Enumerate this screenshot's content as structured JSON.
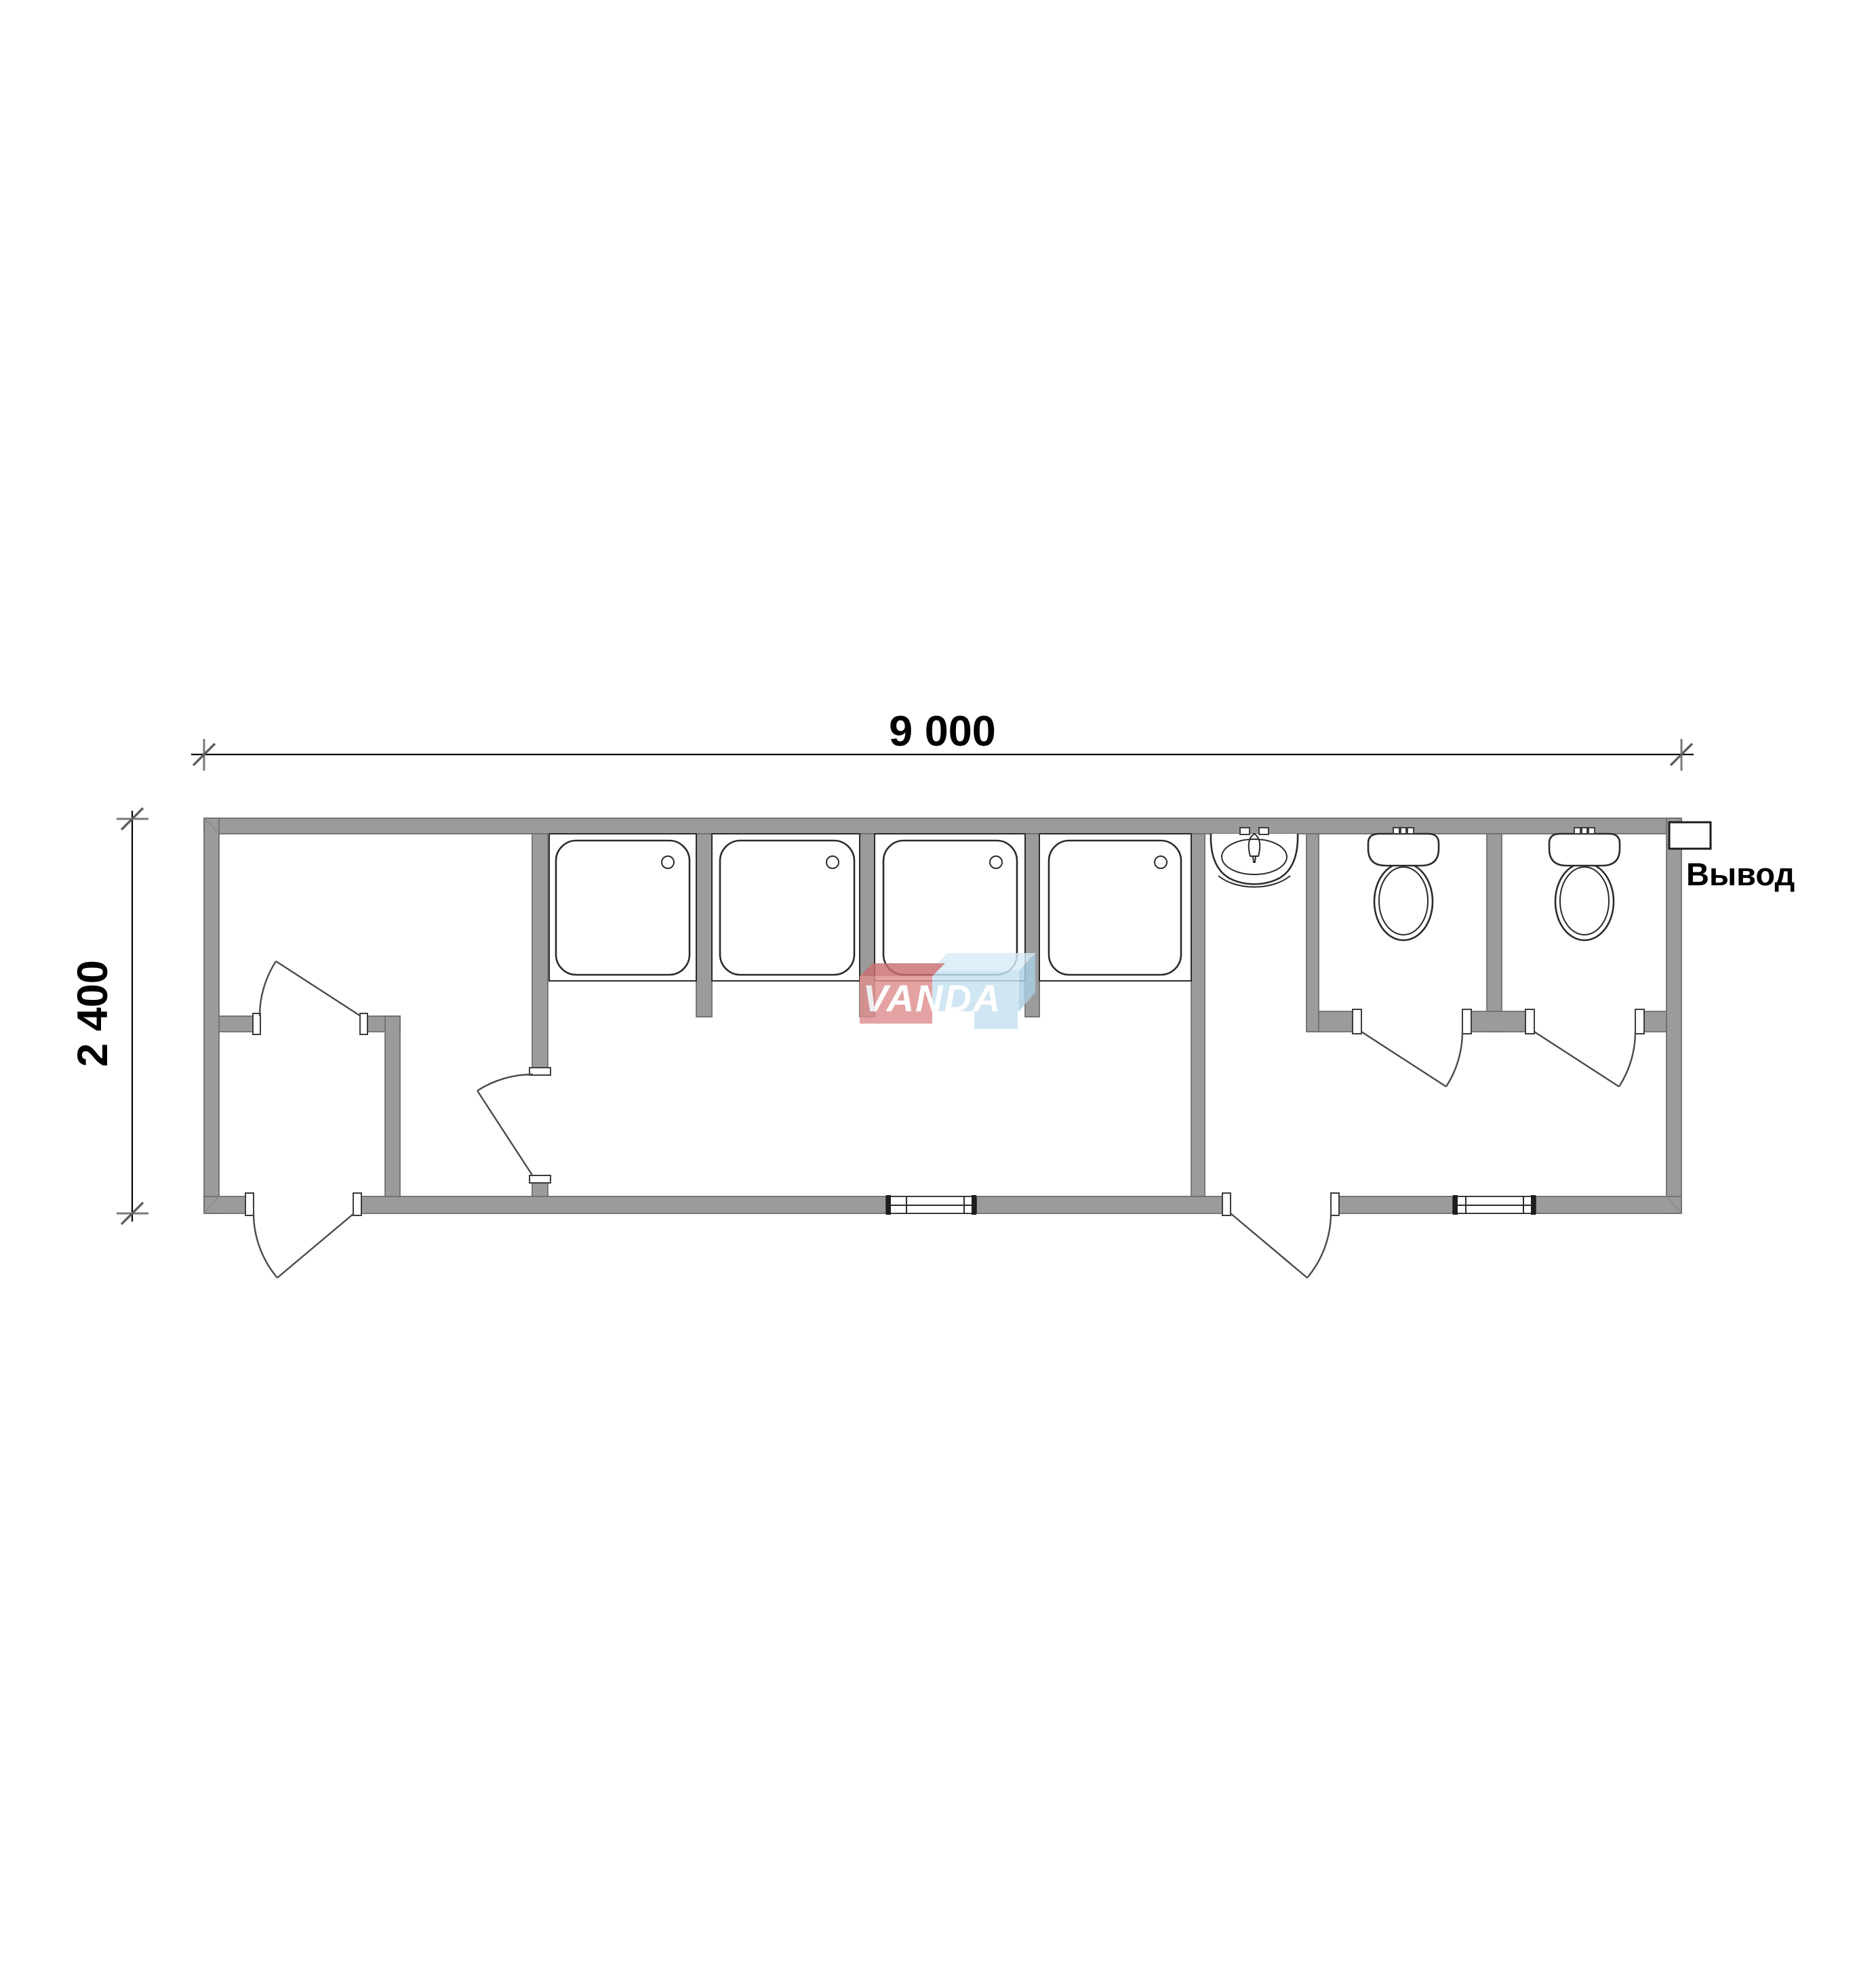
{
  "dimensions": {
    "width_label": "9 000",
    "height_label": "2 400"
  },
  "callouts": {
    "outlet_label": "Вывод"
  },
  "watermark": {
    "text": "VANDA"
  },
  "colors": {
    "background": "#ffffff",
    "wall_fill": "#9b9b9b",
    "wall_edge": "#6f6f6f",
    "line": "#2b2b2b",
    "door": "#4a4a4a",
    "dim": "#000000",
    "tick": "#7a7a7a",
    "logo_red": "#e08e8e",
    "logo_red_dark": "#ca6f72",
    "logo_blue": "#c6e1f0",
    "logo_blue_light": "#d9ecf6",
    "logo_blue_dark": "#a9cfe4",
    "logo_text": "#ffffff"
  }
}
